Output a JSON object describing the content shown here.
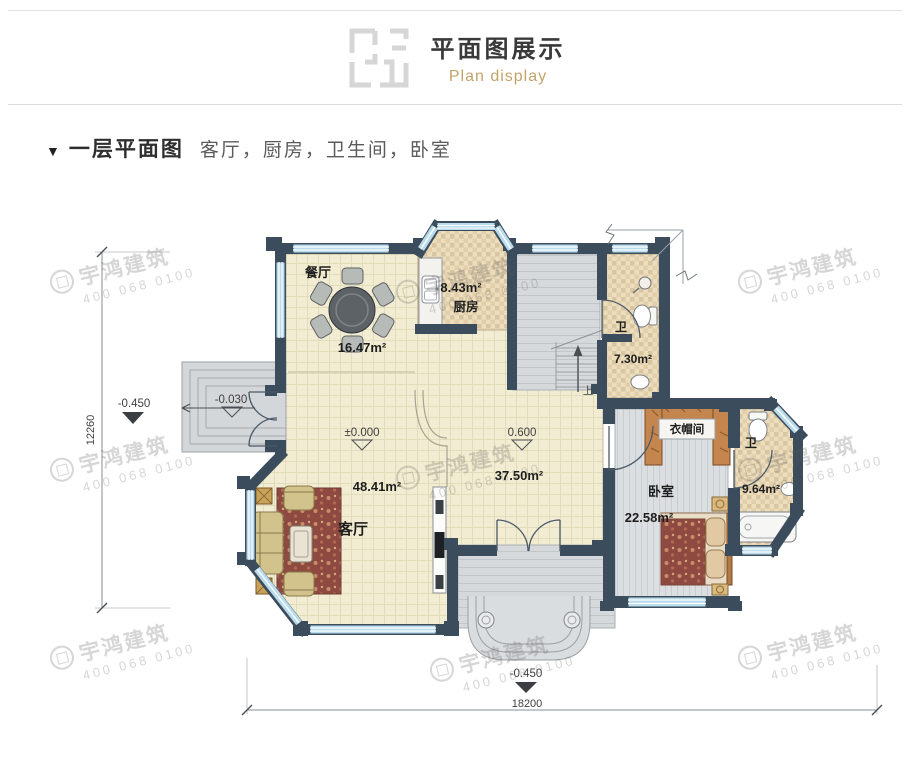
{
  "header": {
    "title": "平面图展示",
    "subtitle": "Plan display"
  },
  "section": {
    "marker": "▼",
    "title": "一层平面图",
    "rooms": "客厅，厨房，卫生间，卧室"
  },
  "plan": {
    "dining": {
      "name": "餐厅",
      "area": "16.47m²"
    },
    "kitchen": {
      "name": "厨房",
      "area": "8.43m²"
    },
    "bath1": {
      "name": "卫",
      "area": "7.30m²"
    },
    "living": {
      "name": "客厅",
      "area": "48.41m²"
    },
    "hall": {
      "area": "37.50m²"
    },
    "bedroom": {
      "name": "卧室",
      "area": "22.58m²"
    },
    "cloakroom": {
      "name": "衣帽间"
    },
    "bath2": {
      "name": "卫",
      "area": "9.64m²"
    },
    "stairs_up": "上",
    "elevations": {
      "west_outside": "-0.450",
      "west_porch": "-0.030",
      "living": "±0.000",
      "hall": "0.600",
      "south": "-0.450"
    },
    "dimensions": {
      "height": "12260",
      "width": "18200"
    }
  },
  "watermark": {
    "name": "宇鸿建筑",
    "phone": "400 068 0100"
  }
}
